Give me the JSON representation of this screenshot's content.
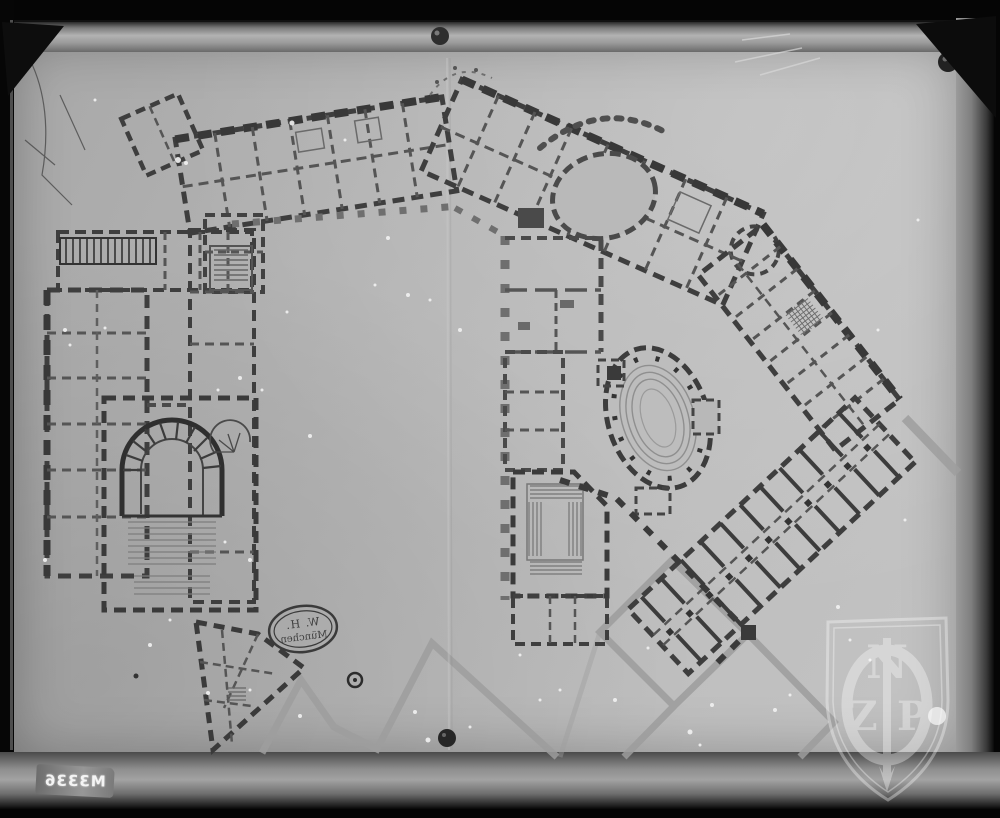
{
  "photo": {
    "plate_number": "M3336"
  },
  "stamp": {
    "line1": "W. H.",
    "line2": "München"
  },
  "watermark": {
    "top": "N",
    "left": "Z",
    "right": "P"
  },
  "colors": {
    "background": "#050505",
    "paper": "#b7b7b7",
    "wall_dark": "#3a3a3a",
    "wall_medium": "#555555",
    "wall_light": "#6f6f6f",
    "faint_path": "#9d9d9d"
  }
}
